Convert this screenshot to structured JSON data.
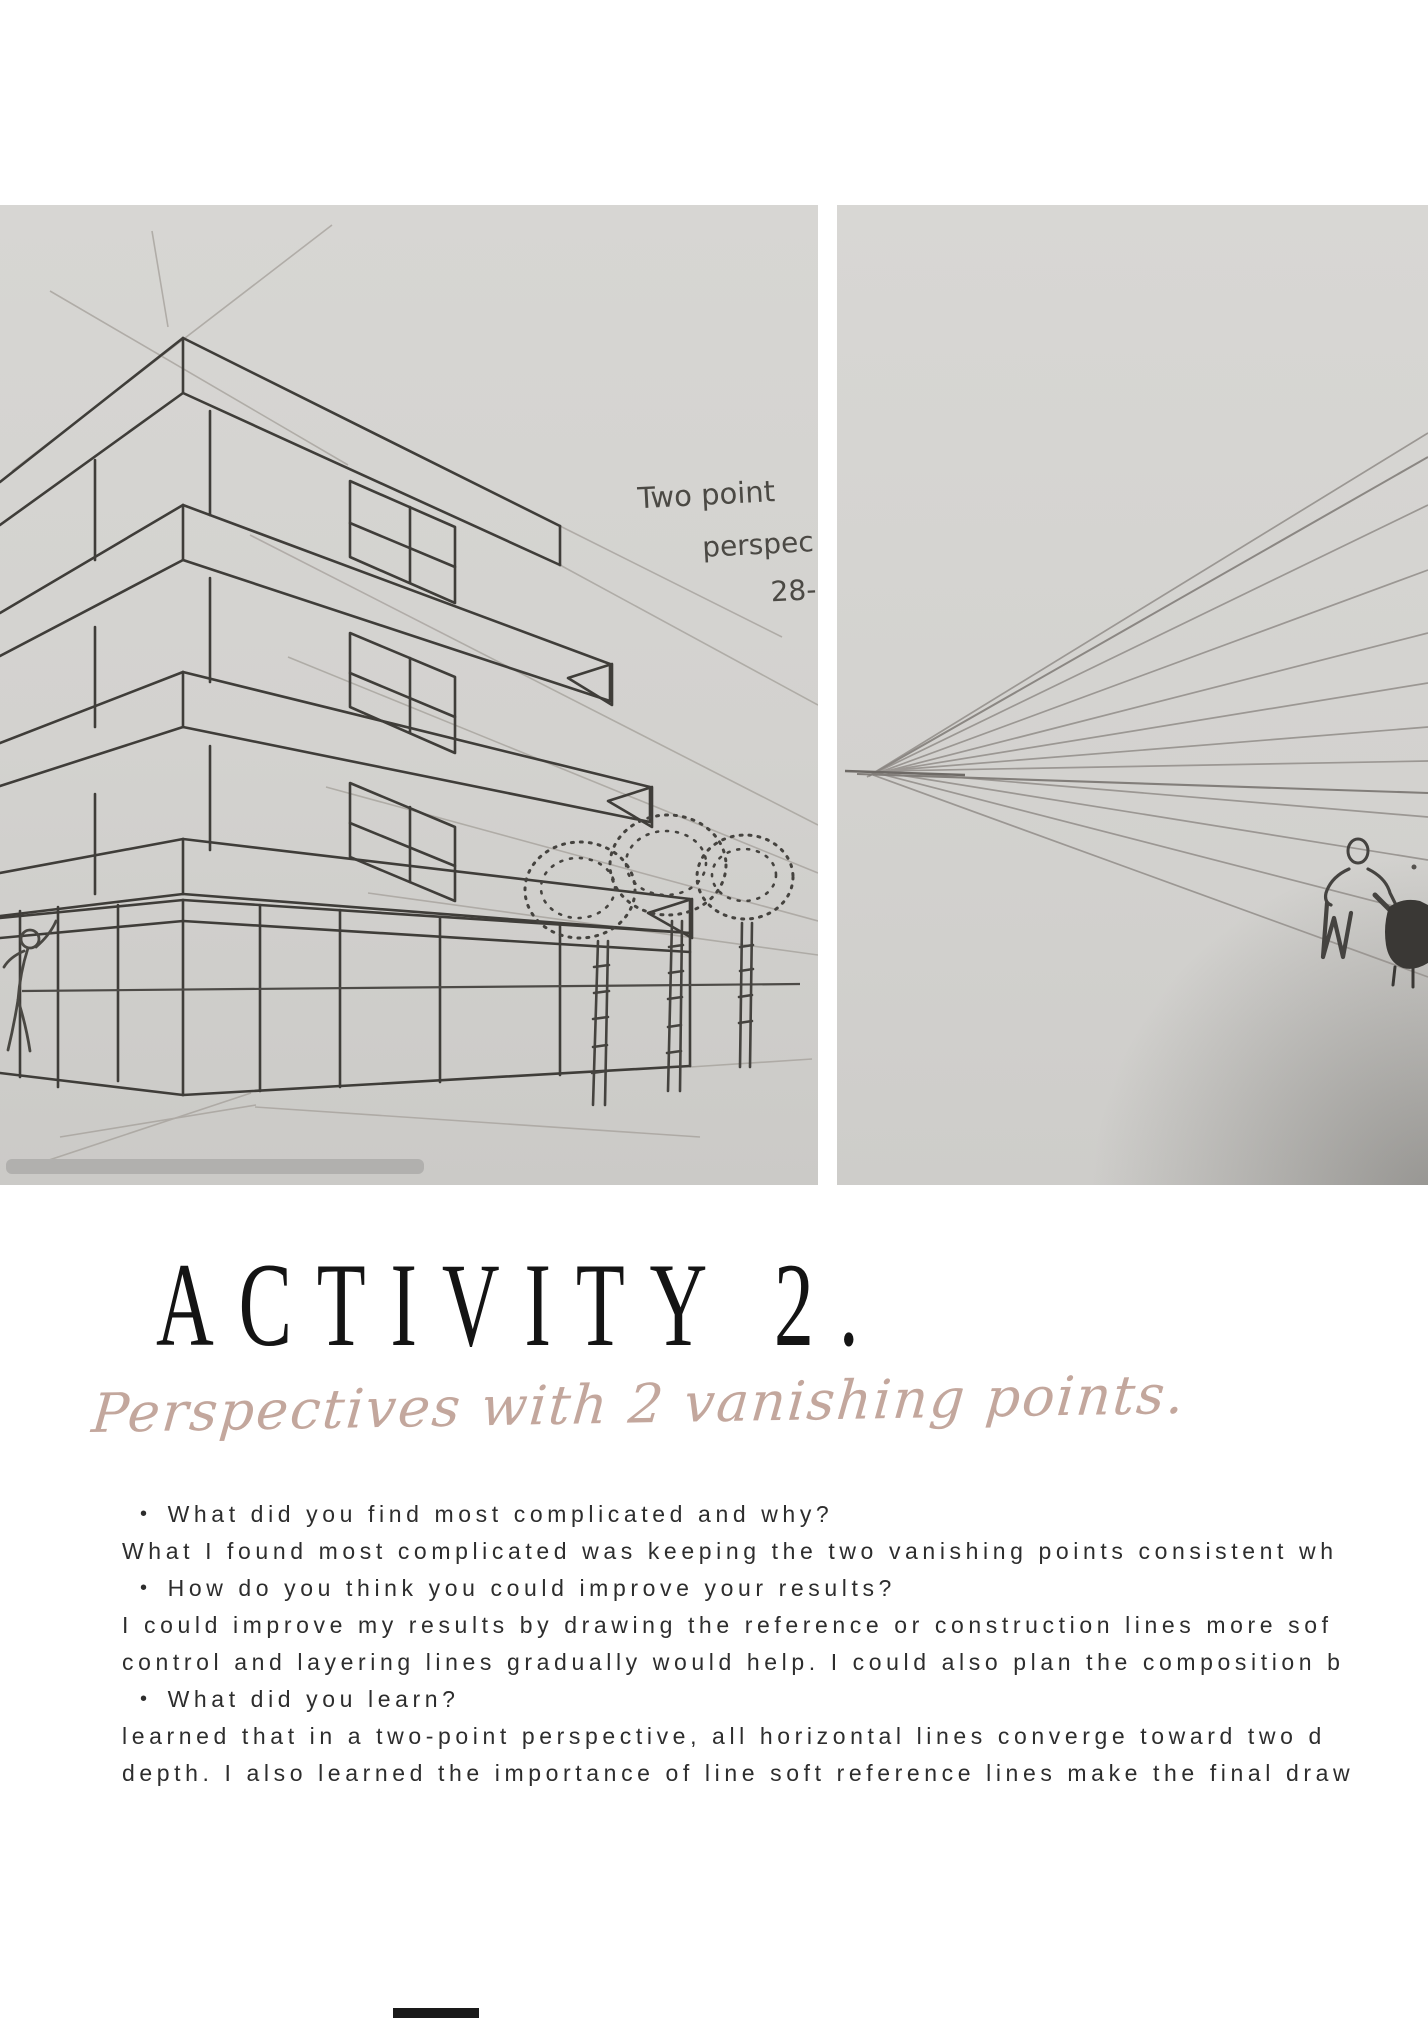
{
  "header": {
    "title": "ACTIVITY 2.",
    "subtitle": "Perspectives with 2 vanishing points."
  },
  "qa": {
    "bullet_char": "•",
    "lines": [
      {
        "bullet": true,
        "text": "What did you find most complicated and why?"
      },
      {
        "bullet": false,
        "text": "What I found most complicated was keeping the two vanishing points consistent wh"
      },
      {
        "bullet": true,
        "text": "How do you think you could improve your results?"
      },
      {
        "bullet": false,
        "text": "I could improve my results by drawing the reference or construction lines more sof"
      },
      {
        "bullet": false,
        "text": "control and layering lines gradually would help. I could also plan the composition b"
      },
      {
        "bullet": true,
        "text": "What did you learn?"
      },
      {
        "bullet": false,
        "text": "learned that in a two-point perspective, all horizontal lines converge toward two d"
      },
      {
        "bullet": false,
        "text": "depth. I also learned the importance of line soft reference lines make the final draw"
      }
    ]
  },
  "left_photo": {
    "annotation": {
      "line1": "Two point",
      "line2": "perspec",
      "line3": "28-"
    }
  },
  "colors": {
    "accent_script": "#c3a79d",
    "title": "#141414",
    "body_text": "#2d2d2d",
    "photo_background": "#d3d2cf",
    "pencil_dark": "#3f3d39",
    "pencil_light": "#a7a39d"
  }
}
